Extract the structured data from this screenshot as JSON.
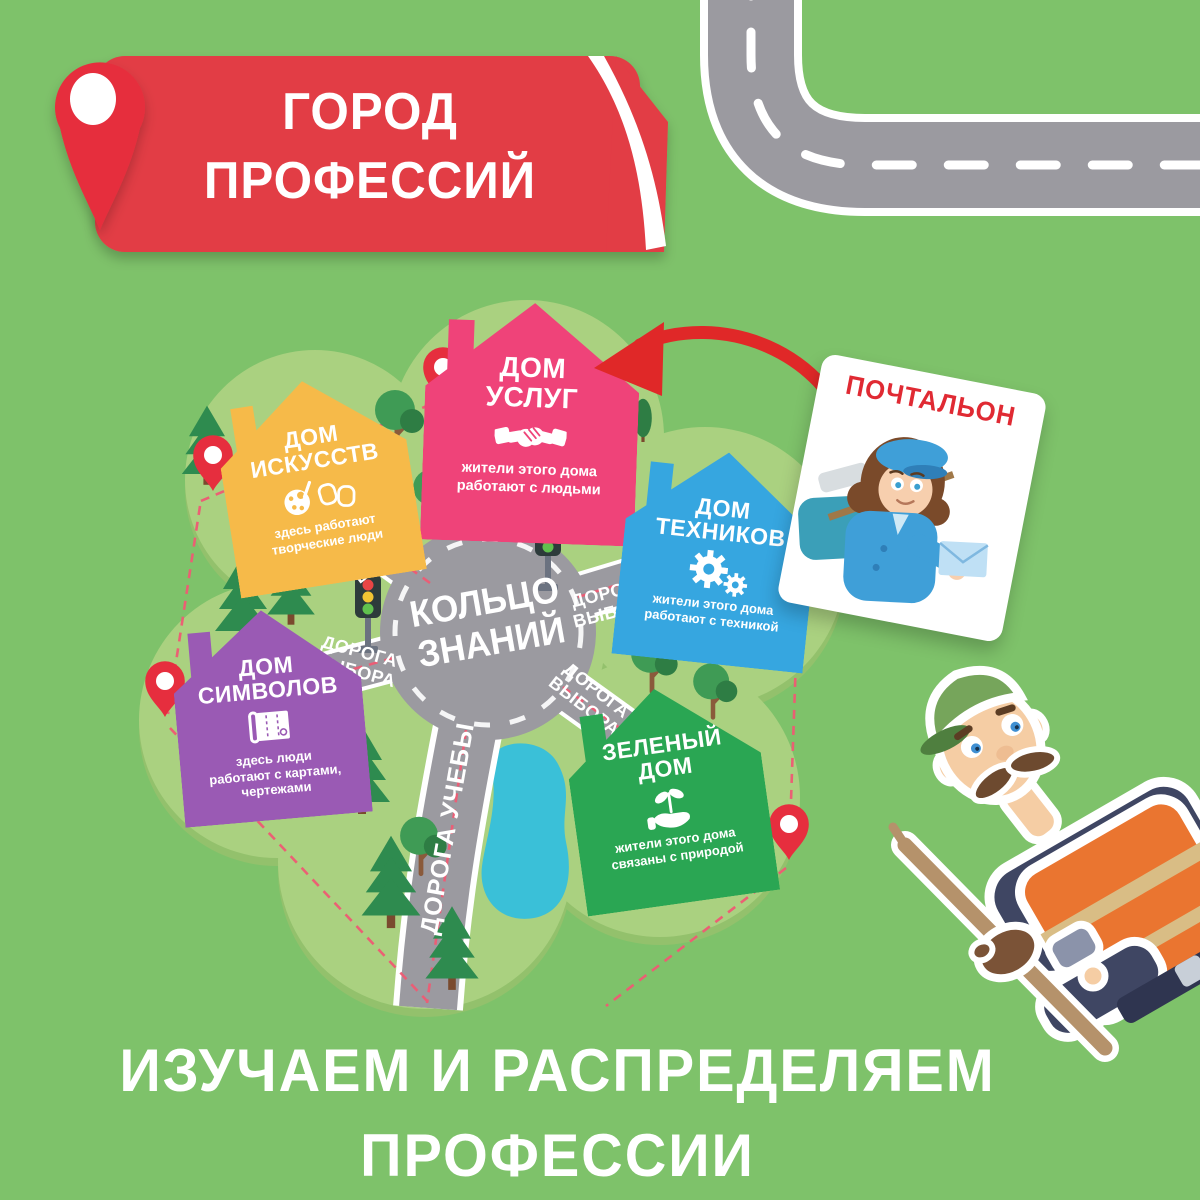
{
  "banner": {
    "title": "ГОРОД\nПРОФЕССИЙ",
    "pin_icon": "location-pin-icon"
  },
  "map": {
    "ring_label": "КОЛЬЦО\nЗНАНИЙ",
    "road_choice_label": "ДОРОГА\nВЫБОРА",
    "road_study_label": "ДОРОГА УЧЕБЫ",
    "houses": [
      {
        "id": "services",
        "title": "ДОМ\nУСЛУГ",
        "description": "жители этого дома\nработают с людьми",
        "icon": "handshake-icon",
        "color": "#ef4379"
      },
      {
        "id": "arts",
        "title": "ДОМ\nИСКУССТВ",
        "description": "здесь работают\nтворческие люди",
        "icon": "palette-and-masks-icon",
        "color": "#f6ba49"
      },
      {
        "id": "tech",
        "title": "ДОМ\nТЕХНИКОВ",
        "description": "жители этого дома\nработают с техникой",
        "icon": "gears-icon",
        "color": "#36a6e0"
      },
      {
        "id": "symbols",
        "title": "ДОМ\nСИМВОЛОВ",
        "description": "здесь люди\nработают с картами,\nчертежами",
        "icon": "map-scroll-icon",
        "color": "#9a5ab4"
      },
      {
        "id": "green",
        "title": "ЗЕЛЕНЫЙ\nДОМ",
        "description": "жители этого дома\nсвязаны с природой",
        "icon": "hand-plant-icon",
        "color": "#2aa653"
      }
    ],
    "markers": "map-pin-icon",
    "traffic_light": "traffic-light-icon"
  },
  "profession_card": {
    "label": "ПОЧТАЛЬОН",
    "illustration": "postwoman-with-letters"
  },
  "bottom_character": "street-cleaner-with-broom",
  "footer": {
    "caption": "ИЗУЧАЕМ И РАСПРЕДЕЛЯЕМ\nПРОФЕССИИ"
  },
  "colors": {
    "background": "#7ec26a",
    "board_green": "#aad180",
    "board_green_shade": "#93c16c",
    "road_gray": "#9b9aa0",
    "banner_red": "#e23c45",
    "pin_red": "#e62e3e",
    "cut_line_red": "#ef5b74",
    "pond_blue": "#3ac0d8",
    "card_label_red": "#e02a33"
  }
}
